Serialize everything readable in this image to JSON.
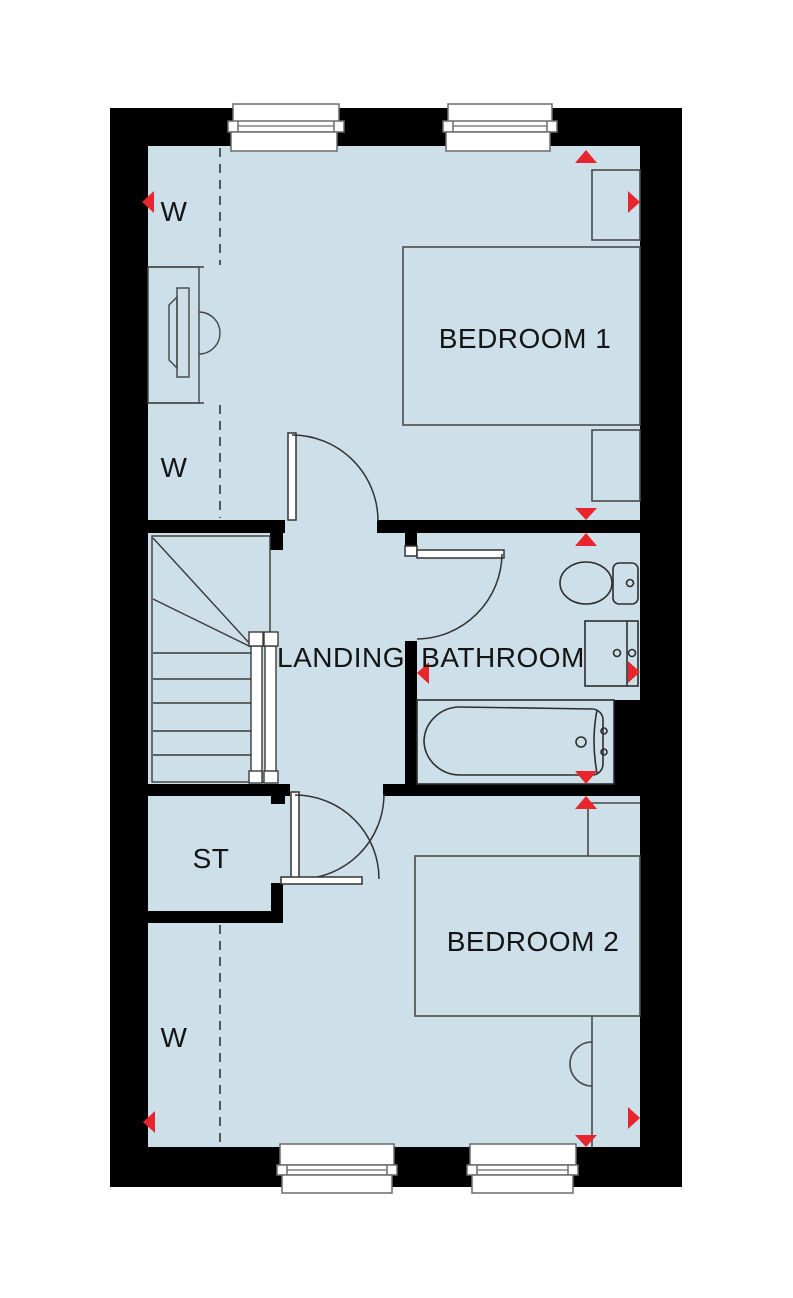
{
  "plan": {
    "type": "floor-plan",
    "floor": "First Floor",
    "rooms": {
      "bedroom1": {
        "label": "BEDROOM 1"
      },
      "bedroom2": {
        "label": "BEDROOM 2"
      },
      "landing": {
        "label": "LANDING"
      },
      "bathroom": {
        "label": "BATHROOM"
      },
      "storage": {
        "label": "ST"
      },
      "wardrobe_top": {
        "label": "W"
      },
      "wardrobe_middle": {
        "label": "W"
      },
      "wardrobe_bottom": {
        "label": "W"
      }
    },
    "fixtures": [
      "bed-double",
      "bedside-table",
      "bedside-table",
      "bed-double",
      "toilet",
      "vanity-basin",
      "bath",
      "stairs",
      "dressing-table"
    ],
    "window_count": 4,
    "door_count": 4,
    "marker_count": 12,
    "colors": {
      "wall": "#000000",
      "floor": "#cddfe8",
      "marker": "#e8242c",
      "background": "#ffffff"
    }
  }
}
